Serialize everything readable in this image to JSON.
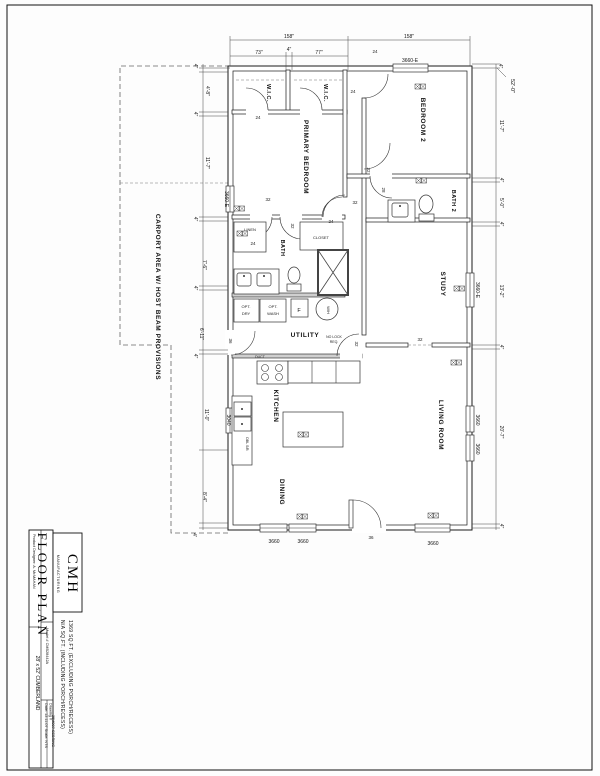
{
  "title_block": {
    "sheet_title": "FLOOR PLAN",
    "attribution": "Product Designer:  A. McMAHAN",
    "brand": "CMH",
    "brand_sub": "MANUFACTURING",
    "sqft_excluding": "1369  SQ.FT.  (EXCLUDING  PORCH/RECESS)",
    "sqft_including": "N/A  SQ.FT.  (INCLUDING  PORCH/RECESS)",
    "model": "Model #  CMB28442A",
    "date_scale": "Date: 12.11.07     Scale: NTS",
    "drawing_label": "Drawing #",
    "drawing_number": "25M007-SEBRING",
    "plan_name": "28' x 52' CUMBERLAND"
  },
  "rooms": {
    "primary": "PRIMARY BEDROOM",
    "bedroom2": "BEDROOM 2",
    "wic": "W.I.C.",
    "bath": "BATH",
    "bath2": "BATH 2",
    "linen": "LINEN",
    "closet": "CLOSET",
    "study": "STUDY",
    "living": "LIVING ROOM",
    "dining": "DINING",
    "kitchen": "KITCHEN",
    "utility": "UTILITY",
    "carport": "CARPORT AREA W/ HOST BEAM PROVISIONS"
  },
  "windows": {
    "w3660e": "3660-E",
    "w3660": "3660",
    "w3040": "3040"
  },
  "doors": {
    "d24": "24",
    "d28": "28",
    "d32": "32",
    "d36": "36"
  },
  "dims": {
    "top": [
      "158\"",
      "158\""
    ],
    "top_sub": [
      "73\"",
      "4\"",
      "77\""
    ],
    "left": [
      "4\"",
      "4'-8\"",
      "4\"",
      "11'-7\"",
      "4\"",
      "7'-6\"",
      "4\"",
      "6'-11\"",
      "4\"",
      "11'-0\"",
      "8'-4\"",
      "4'"
    ],
    "right": [
      "4\"",
      "52'-0\"",
      "11'-7\"",
      "4\"",
      "5'-0\"",
      "4\"",
      "13'-2\"",
      "4\"",
      "20'-7\"",
      "4\""
    ]
  },
  "labels": {
    "opt": "OPT.",
    "dry": "DRY",
    "wash": "WASH",
    "furnace": "F",
    "water_heater": "W/H",
    "kitchen_sink": "DBL S/B",
    "duct": "DUCT",
    "no_lock_1": "NO LOCK",
    "no_lock_2": "REQ."
  }
}
